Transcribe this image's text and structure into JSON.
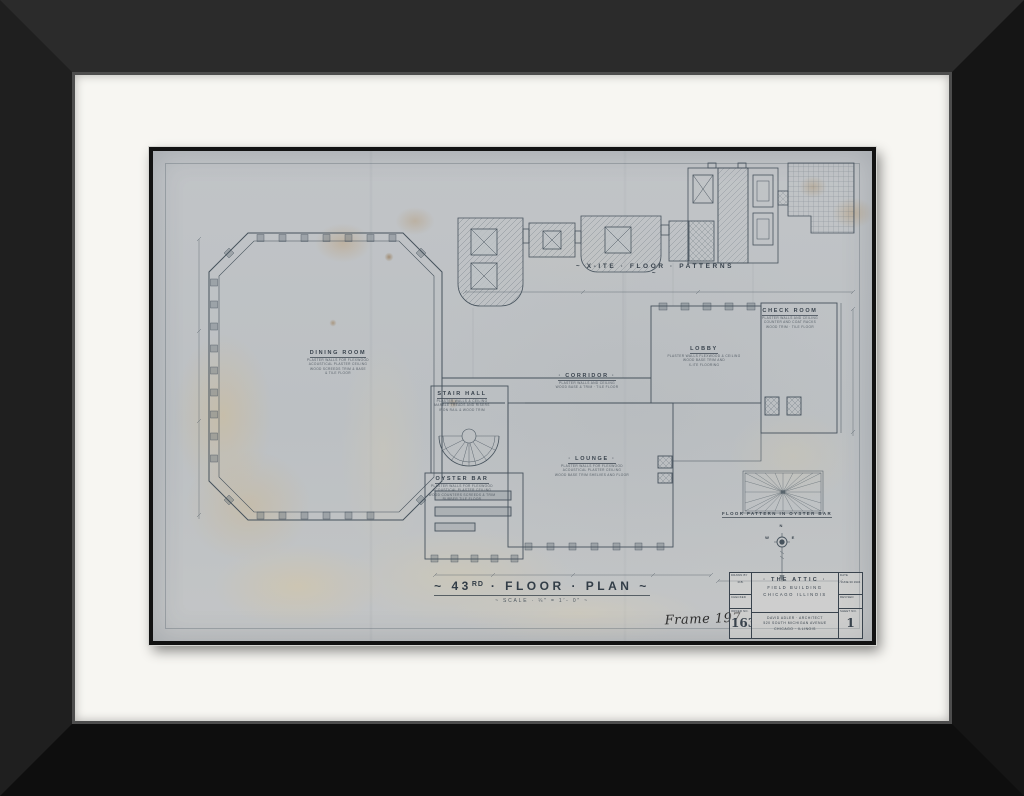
{
  "artwork": {
    "title_prefix": "~ 43",
    "title_sup": "RD",
    "title_rest": " · FLOOR · PLAN ~",
    "scale_note": "~ SCALE · ¼″ = 1′- 0″ ~",
    "frame_annotation": "Frame 197"
  },
  "pattern_labels": {
    "top": "~ X-ITE · FLOOR · PATTERNS ~",
    "oyster_bar": "FLOOR PATTERN IN OYSTER BAR"
  },
  "rooms": {
    "dining": {
      "name": "DINING ROOM",
      "notes": [
        "PLASTER WALLS FOR FLEXWOOD",
        "ACOUSTICAL PLASTER CEILING",
        "WOOD SCREEDS TRIM & BASE",
        "& TILE FLOOR"
      ]
    },
    "stair_hall": {
      "name": "STAIR HALL",
      "notes": [
        "PLASTER WALLS & CEILING",
        "MARBLE TREADS AND RISERS",
        "IRON RAIL & WOOD TRIM"
      ]
    },
    "oyster_bar": {
      "name": "OYSTER BAR",
      "notes": [
        "PLASTER WALLS FOR FLEXWOOD",
        "ACOUSTICAL PLASTER CEILING",
        "WOOD COUNTERS SCREEDS & TRIM",
        "RUBBER TILE FLOOR"
      ]
    },
    "lounge": {
      "name": "· LOUNGE ·",
      "notes": [
        "PLASTER WALLS FOR FLEXWOOD",
        "ACOUSTICAL PLASTER CEILING",
        "WOOD BASE TRIM SHELVES AND FLOOR"
      ]
    },
    "corridor": {
      "name": "· CORRIDOR ·",
      "notes": [
        "PLASTER WALLS AND CEILING",
        "WOOD BASE & TRIM · TILE FLOOR"
      ]
    },
    "lobby": {
      "name": "LOBBY",
      "notes": [
        "PLASTER WALLS FLEXWOOD & CEILING",
        "WOOD BASE TRIM AND",
        "X-ITE FLOORING"
      ]
    },
    "check_room": {
      "name": "CHECK ROOM",
      "notes": [
        "PLASTER WALLS AND CEILING",
        "COUNTER AND COAT RACKS",
        "WOOD TRIM · TILE FLOOR"
      ]
    }
  },
  "compass": {
    "north": "N",
    "west": "W",
    "east": "E"
  },
  "title_block": {
    "project_line1": "· THE  ATTIC ·",
    "project_line2": "FIELD  BUILDING",
    "project_line3": "CHICAGO  ILLINOIS",
    "architect_line1": "DAVID ADLER · ARCHITECT",
    "architect_line2": "520 SOUTH MICHIGAN AVENUE",
    "architect_line3": "CHICAGO · ILLINOIS",
    "drawn_by_label": "DRAWN BY",
    "drawn_by_value": "R.B.",
    "checked_label": "CHECKED",
    "order_no_label": "ORDER NO.",
    "order_no_value": "163",
    "date_label": "DATE",
    "date_value": "JUNE 30 1934",
    "revised_label": "REVISED",
    "sheet_no_label": "SHEET NO.",
    "sheet_no_value": "1"
  },
  "colors": {
    "ink": "#46525c",
    "paper": "#bfc3c6",
    "mat": "#f7f6f2",
    "frame": "#1c1c1c",
    "stain": "#cdb890"
  }
}
